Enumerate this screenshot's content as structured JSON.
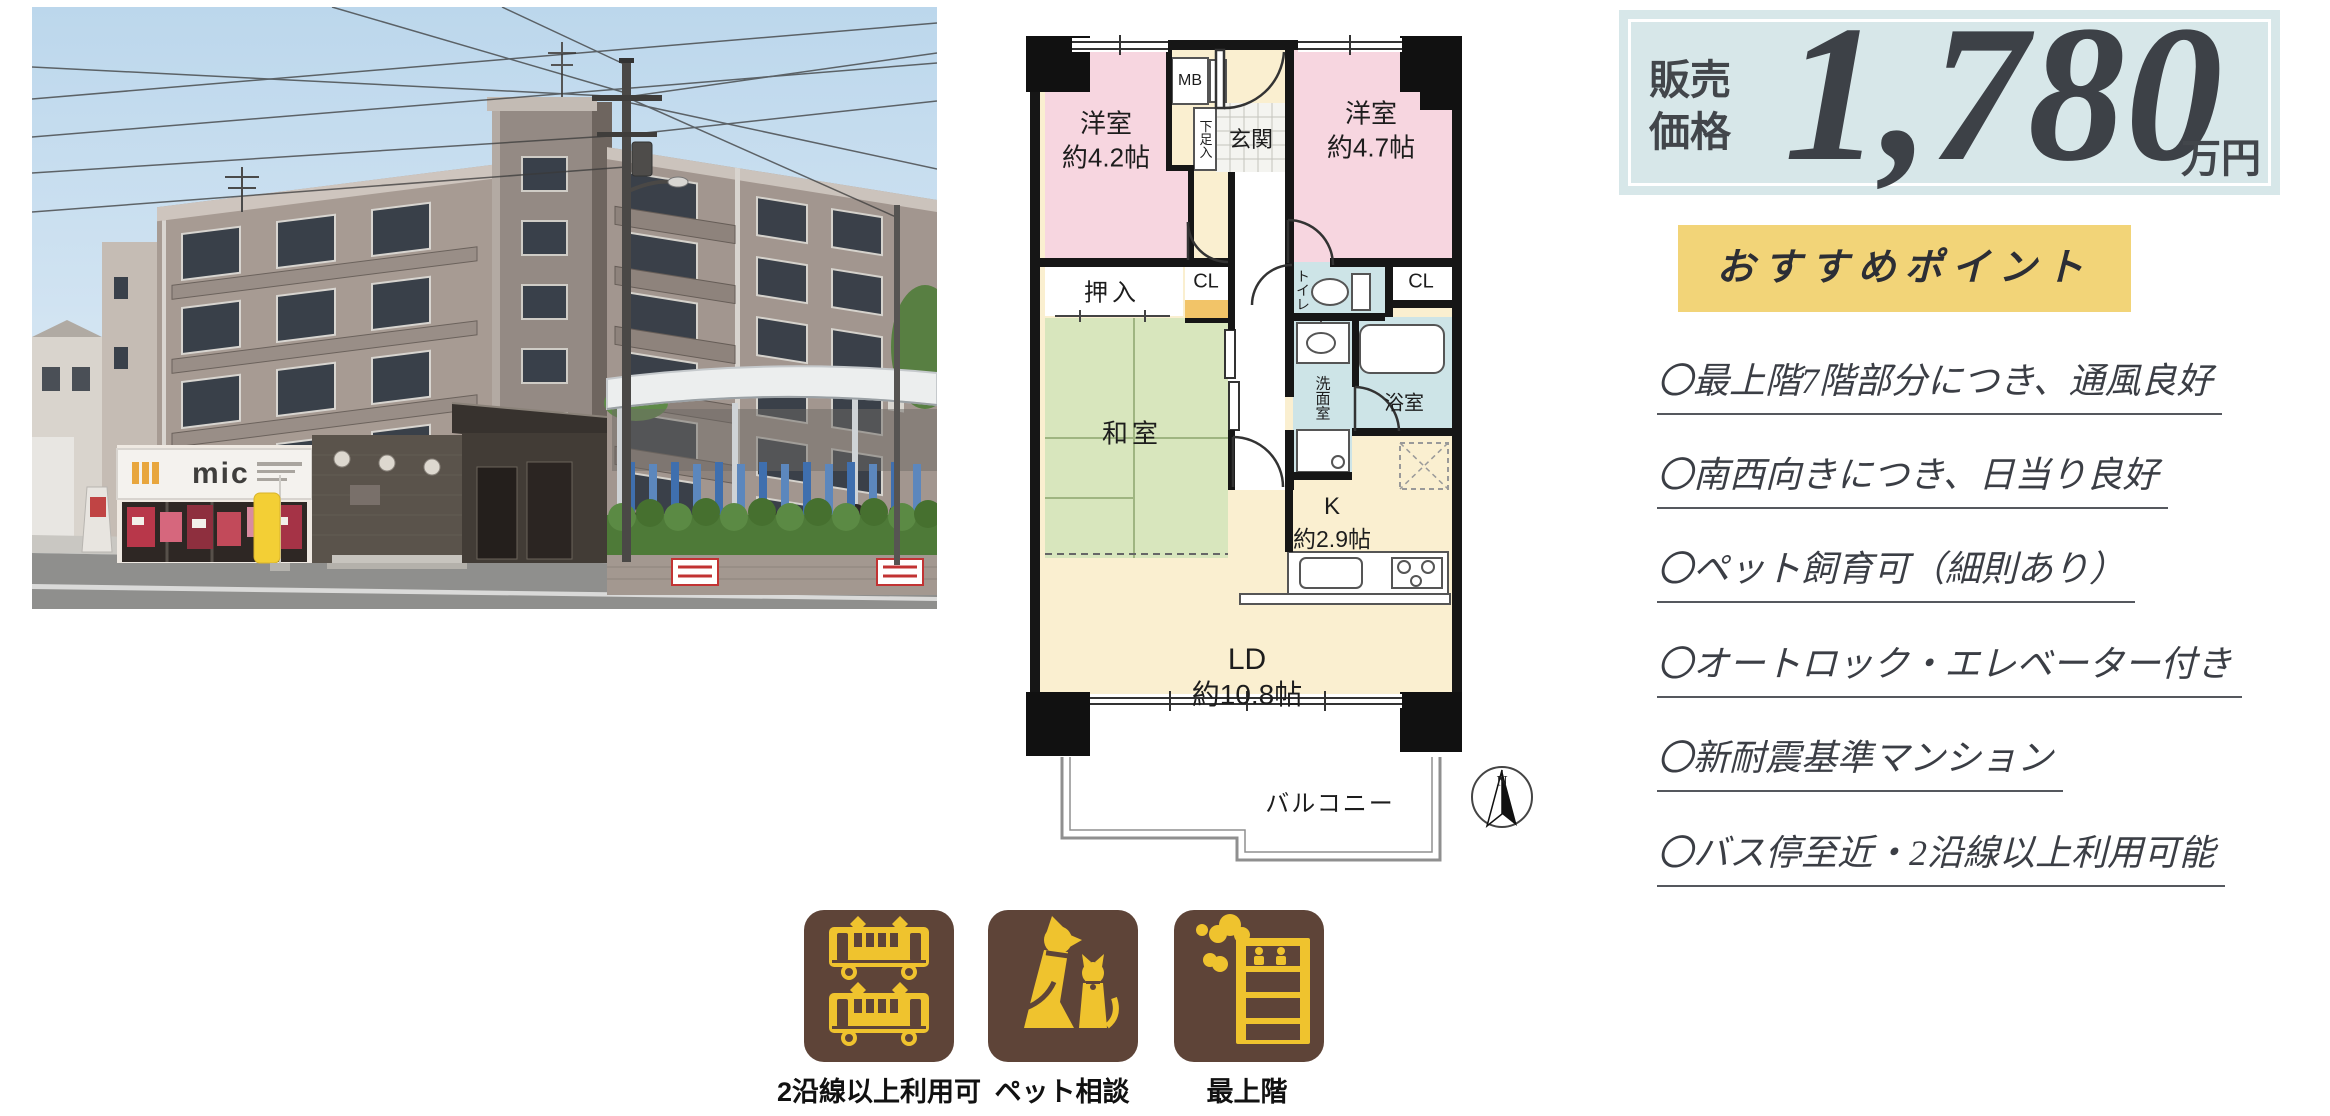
{
  "photo": {
    "store_sign": "mic"
  },
  "price": {
    "label_top": "販売",
    "label_bottom": "価格",
    "amount": "1,780",
    "unit": "万円"
  },
  "recommend": {
    "title": "おすすめポイント",
    "points": [
      "〇最上階7階部分につき、通風良好",
      "〇南西向きにつき、日当り良好",
      "〇ペット飼育可（細則あり）",
      "〇オートロック・エレベーター付き",
      "〇新耐震基準マンション",
      "〇バス停至近・2沿線以上利用可能"
    ]
  },
  "floorplan": {
    "room_west1": "洋室",
    "room_west1_size": "約4.2帖",
    "room_west2": "洋室",
    "room_west2_size": "約4.7帖",
    "mb": "MB",
    "entrance": "玄関",
    "shoe_box": "下足入",
    "oshiire": "押入",
    "cl_center": "CL",
    "cl_right": "CL",
    "toilet": "トイレ",
    "washroom": "洗面室",
    "bathroom": "浴室",
    "japanese_room": "和室",
    "kitchen": "K",
    "kitchen_size": "約2.9帖",
    "living": "LD",
    "living_size": "約10.8帖",
    "balcony": "バルコニー",
    "compass_north": "N"
  },
  "badges": [
    {
      "icon": "train-icon",
      "label": "2沿線以上利用可"
    },
    {
      "icon": "pet-icon",
      "label": "ペット相談"
    },
    {
      "icon": "top-floor-icon",
      "label": "最上階"
    }
  ],
  "colors": {
    "price_bg": "#d7e7e9",
    "highlight_bg": "#f2d478",
    "badge_brown": "#5e4438",
    "badge_gold": "#efc32e",
    "plan_pink": "#f7d6e0",
    "plan_green": "#d8e6bd",
    "plan_cream": "#faefd0",
    "plan_blue": "#cde4e7",
    "plan_orange": "#f2c468"
  }
}
